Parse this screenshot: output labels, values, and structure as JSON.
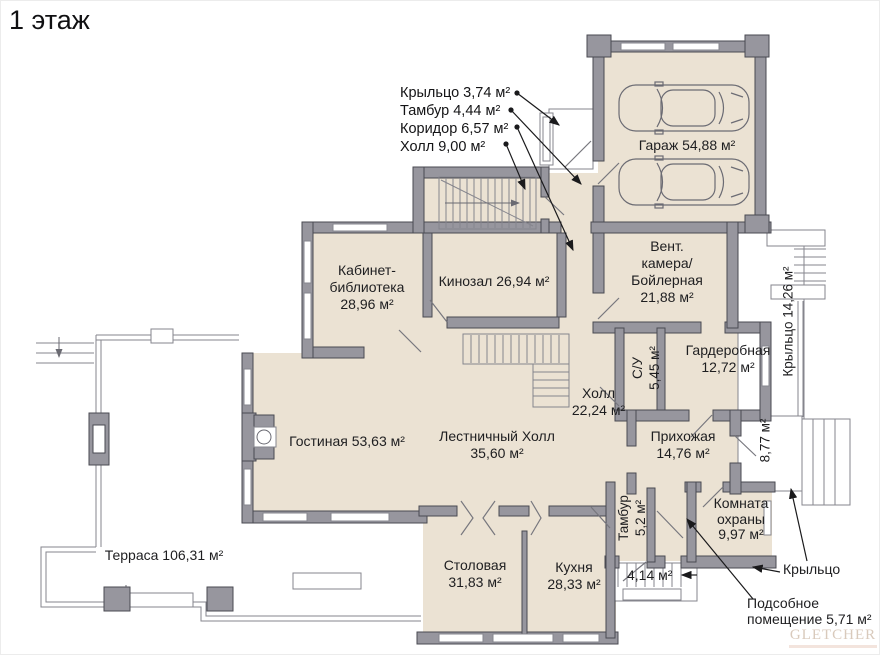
{
  "title": "1 этаж",
  "callouts": [
    "Крыльцо 3,74 м²",
    "Тамбур 4,44 м²",
    "Коридор 6,57 м²",
    "Холл 9,00 м²"
  ],
  "rooms": {
    "garage": {
      "text": "Гараж 54,88 м²"
    },
    "kabinet": {
      "line1": "Кабинет-",
      "line2": "библиотека",
      "area": "28,96 м²"
    },
    "kinozal": {
      "text": "Кинозал 26,94 м²"
    },
    "vent": {
      "line1": "Вент.",
      "line2": "камера/",
      "line3": "Бойлерная",
      "area": "21,88 м²"
    },
    "porch_right": {
      "text": "Крыльцо 14,26 м²"
    },
    "su": {
      "line1": "С/У",
      "line2": "5,45 м²"
    },
    "garderobnaya": {
      "line1": "Гардеробная",
      "area": "12,72 м²"
    },
    "holl": {
      "line1": "Холл",
      "area": "22,24 м²"
    },
    "lestnichny_holl": {
      "line1": "Лестничный Холл",
      "area": "35,60 м²"
    },
    "gostinaya": {
      "text": "Гостиная 53,63 м²"
    },
    "prihozhaya": {
      "line1": "Прихожая",
      "area": "14,76 м²"
    },
    "porch_877": {
      "text": "8,77 м²"
    },
    "komnata_ohrany": {
      "line1": "Комната",
      "line2": "охраны",
      "area": "9,97 м²"
    },
    "tambur_52": {
      "line1": "Тамбур",
      "line2": "5,2 м²"
    },
    "stolovaya": {
      "line1": "Столовая",
      "area": "31,83 м²"
    },
    "kuhnya": {
      "line1": "Кухня",
      "area": "28,33 м²"
    },
    "terrasa": {
      "text": "Терраса 106,31 м²"
    },
    "steps_414": {
      "text": "4,14 м²"
    },
    "porch_label": {
      "text": "Крыльцо"
    },
    "podsobnoe": {
      "line1": "Подсобное",
      "line2": "помещение 5,71 м²"
    }
  },
  "logo": {
    "text": "GLETCHER"
  },
  "colors": {
    "room_fill": "#ebe2d3",
    "wall": "#97969e",
    "wall_outline": "#4a4a52",
    "thin_line": "#85858d",
    "text": "#1e1e20",
    "logo": "#d9cabc"
  }
}
